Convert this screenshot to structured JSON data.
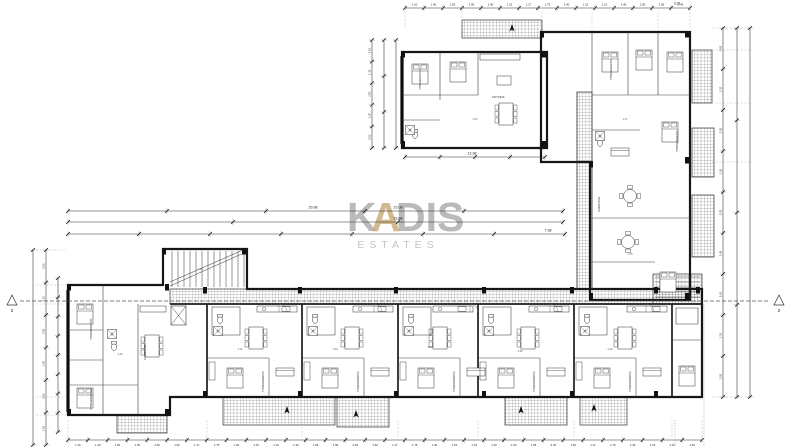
{
  "sheet": {
    "background": "#ffffff"
  },
  "watermark": {
    "brand_k": "K",
    "brand_a": "A",
    "brand_dis": "DIS",
    "subtitle": "ESTATES",
    "accent_color": "#C9A873",
    "text_color": "#A9A9A9",
    "subtitle_color": "#BDBDBD"
  },
  "rooms": {
    "bedroom": "ΥΠΝΟΔΩΜΑΤΙΟ",
    "living": "ΚΑΘΙΣΤΙΚΟ",
    "kitchen": "ΚΟΥΖΙΝΑ",
    "bath": "ΜΠΑΝΙΟ",
    "veranda": "ΒΕΡΑΝΤΑ"
  },
  "dimensions": {
    "overall_left_wing": "29.98",
    "overall_width_top": "23.08",
    "overall_width_mid": "23.88",
    "segment_right": "7.98",
    "left_apartment_width": "12.98",
    "top_right_segment": "3.19",
    "tick_pattern": [
      "1.10",
      "1.40",
      "1.00",
      "1.95",
      "2.40",
      "1.52",
      "1.17",
      "1.75",
      "1.40",
      "1.15"
    ],
    "side_tick_pattern": [
      "3.63",
      "1.15",
      "2.91",
      "1.20",
      "3.52",
      "1.43"
    ]
  },
  "section_markers": {
    "left": "2",
    "right": "2"
  },
  "colors": {
    "wall": "#161616",
    "partition": "#3c3c3c",
    "hatch": "#4f4f4f",
    "dimension": "#2b2b2b",
    "guide": "#8a8a8a"
  }
}
